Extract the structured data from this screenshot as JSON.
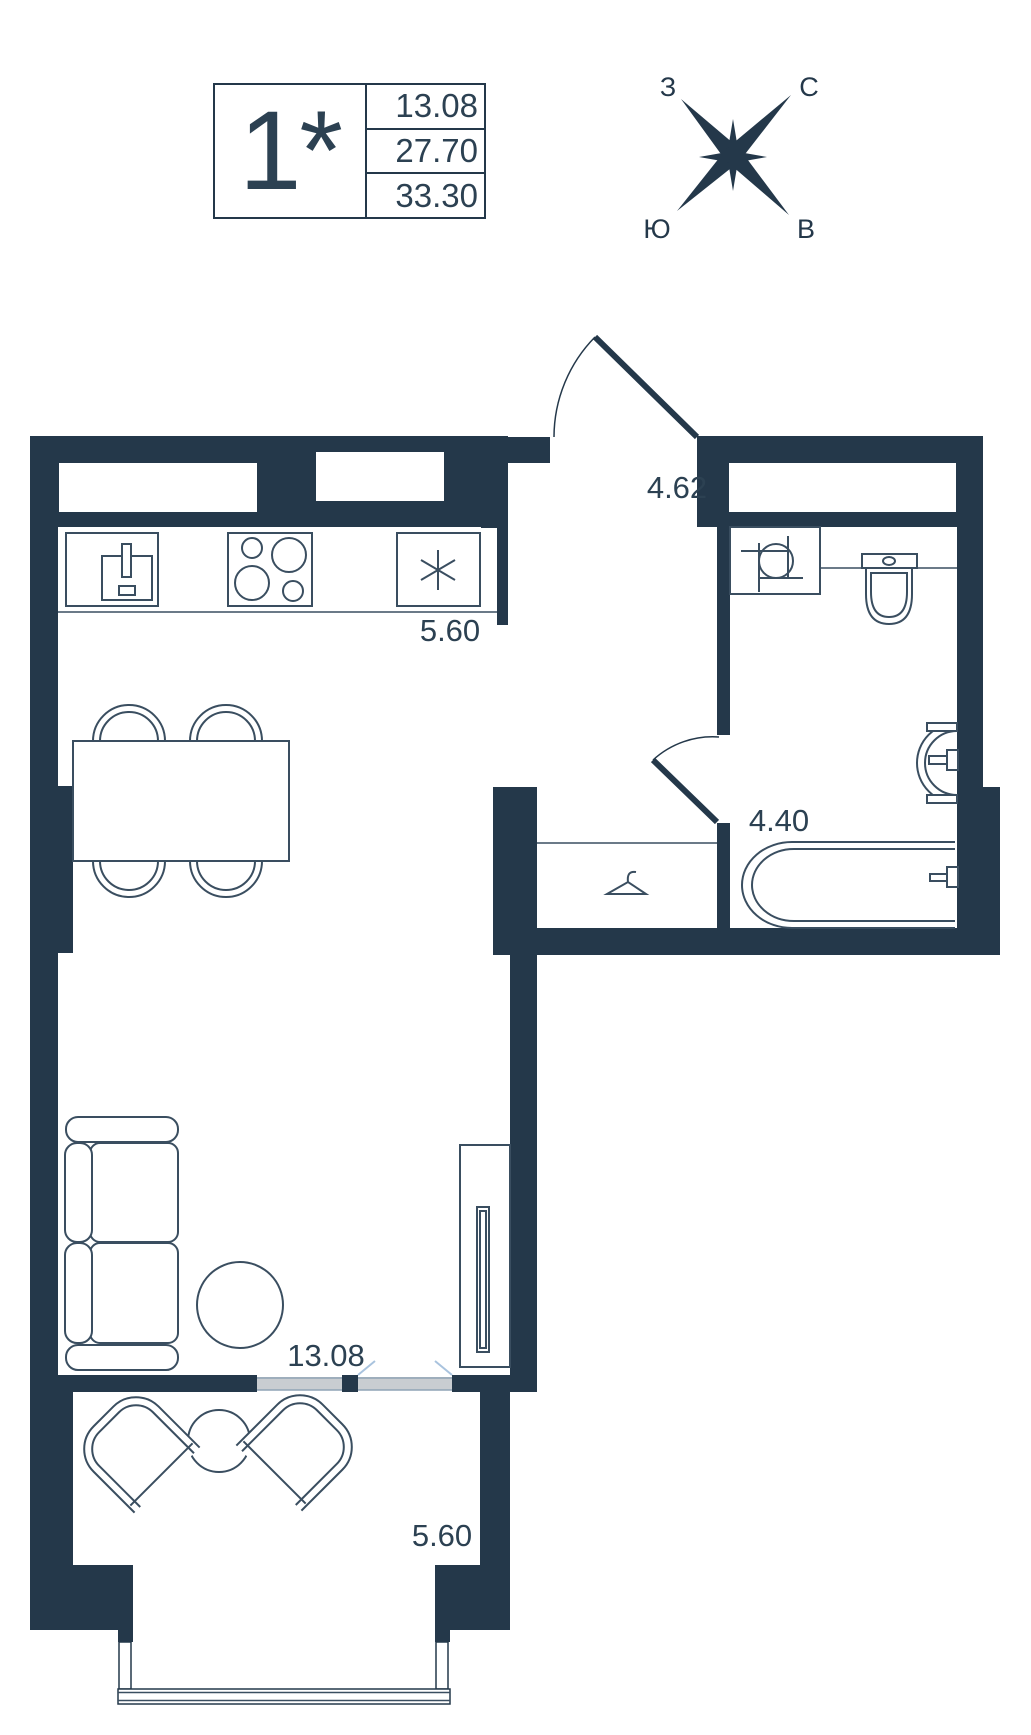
{
  "legend": {
    "unit_label": "1*",
    "rows": [
      "13.08",
      "27.70",
      "33.30"
    ]
  },
  "compass": {
    "west": "З",
    "north": "С",
    "south": "Ю",
    "east": "В"
  },
  "rooms": {
    "hallway_area": "4.62",
    "kitchen_area": "5.60",
    "bathroom_area": "4.40",
    "living_area": "13.08",
    "balcony_area": "5.60"
  },
  "colors": {
    "wall": "#24384a",
    "furniture_line": "#3a4e60",
    "text": "#2c4152",
    "glazing_fill": "#c9cdd1",
    "glazing_line": "#8fa3b5",
    "tick": "#a9c3de"
  },
  "icons": [
    "compass-star-icon",
    "kitchen-sink-icon",
    "stove-icon",
    "fridge-snowflake-icon",
    "dining-table",
    "dining-chair",
    "sofa",
    "side-table",
    "tv-stand",
    "coat-hanger-icon",
    "washbasin-icon",
    "toilet-icon",
    "corner-sink-icon",
    "bathtub-icon",
    "balcony-chair",
    "balcony-table",
    "entrance-door",
    "bathroom-door",
    "window",
    "balcony-glazing"
  ]
}
